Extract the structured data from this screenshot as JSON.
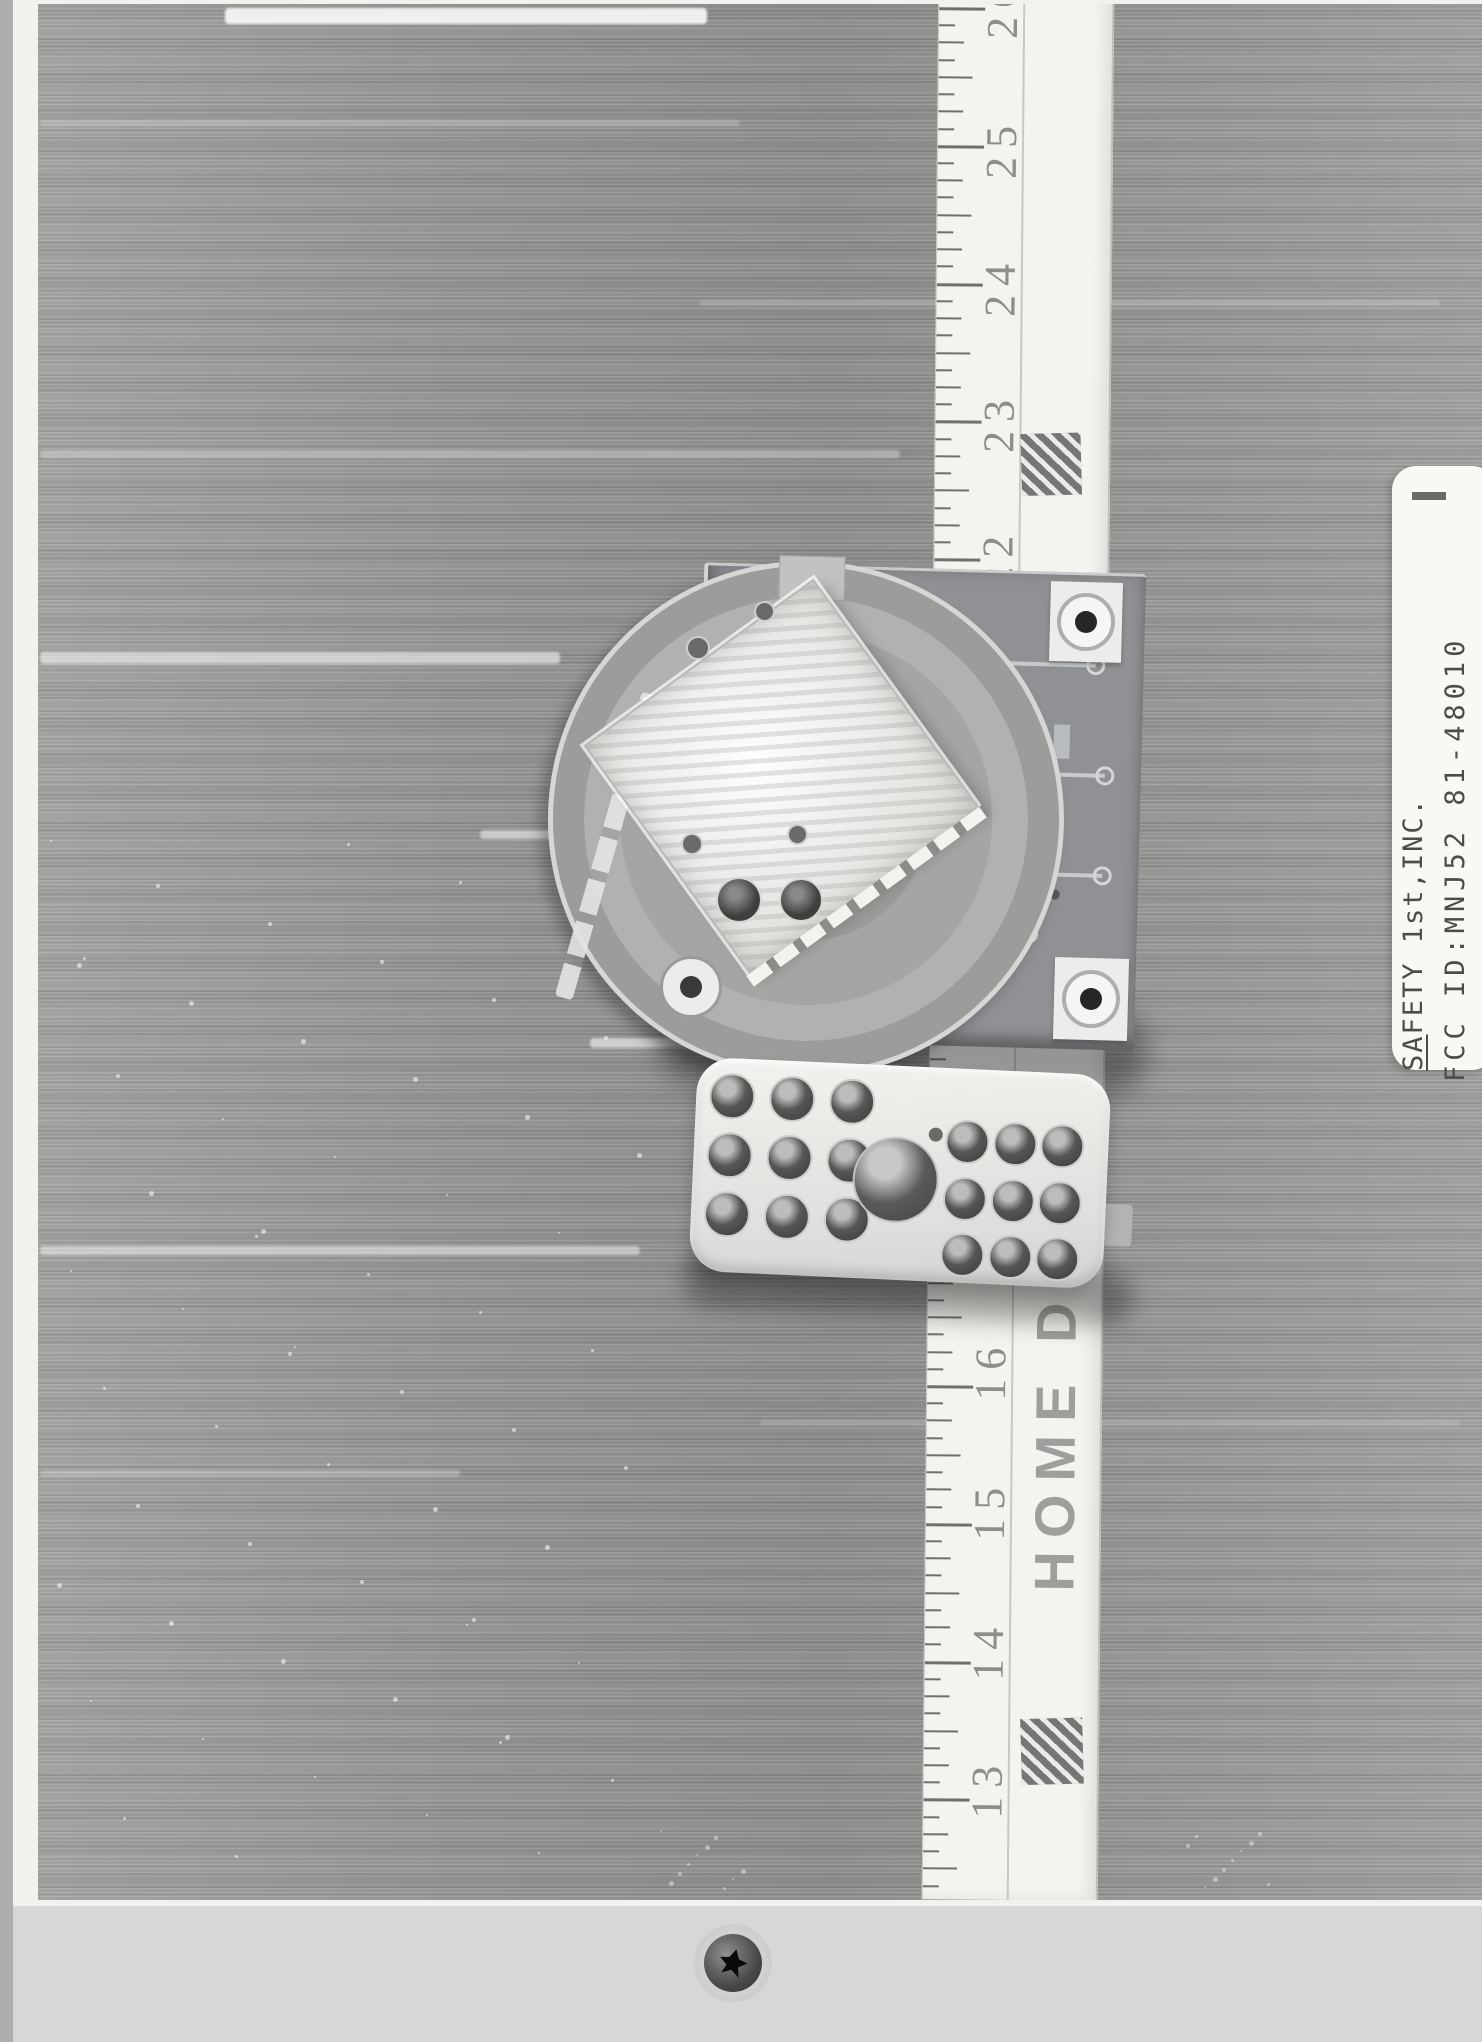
{
  "scan": {
    "description": "Photocopied test-report photograph: device sample with ruler on carpet",
    "carpet_color": "#9c9c9a",
    "paper_color": "#f1f1ee",
    "platen_color": "#d7d7d8"
  },
  "ruler": {
    "brand_text": "HOME DE",
    "top_inch_y": 10,
    "inch_px": 137.8,
    "unit_numbers": [
      {
        "label": "26",
        "y": 10
      },
      {
        "label": "25",
        "y": 150
      },
      {
        "label": "24",
        "y": 288
      },
      {
        "label": "23",
        "y": 424
      },
      {
        "label": "22",
        "y": 560
      },
      {
        "label": "16",
        "y": 1372
      },
      {
        "label": "15",
        "y": 1512
      },
      {
        "label": "14",
        "y": 1652
      },
      {
        "label": "13",
        "y": 1790
      }
    ]
  },
  "label": {
    "company_prefix": "SA",
    "company_rest": "FETY 1st,INC.",
    "fcc_line": "FCC ID:MNJ52 81-48010"
  }
}
